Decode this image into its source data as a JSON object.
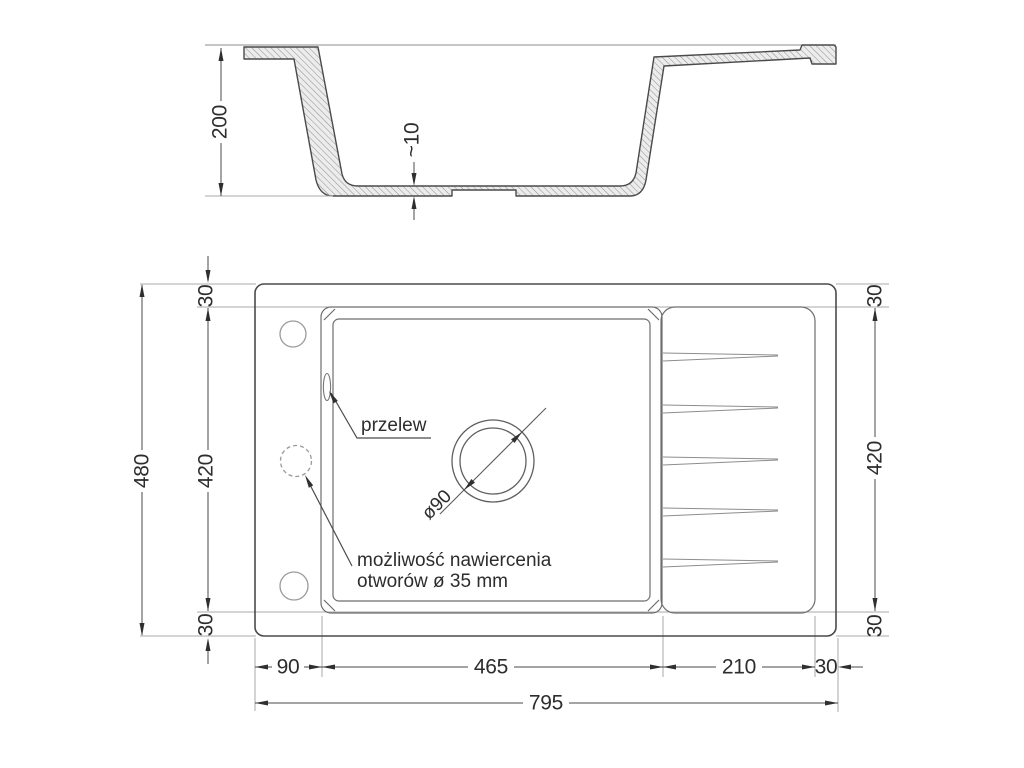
{
  "drawing": {
    "kind": "kitchen-sink technical drawing, section view and plan view",
    "dims": {
      "depth": "200",
      "thickness": "~10",
      "overall_length": "795",
      "overall_width": "480",
      "inner_width": "420",
      "margin": "30",
      "left_offset": "90",
      "bowl_length": "465",
      "drainer_length": "210"
    },
    "labels": {
      "drain_diameter": "ø90",
      "overflow": "przelew",
      "drill_note_line1": "możliwość nawiercenia",
      "drill_note_line2": "otworów ø 35 mm"
    }
  }
}
